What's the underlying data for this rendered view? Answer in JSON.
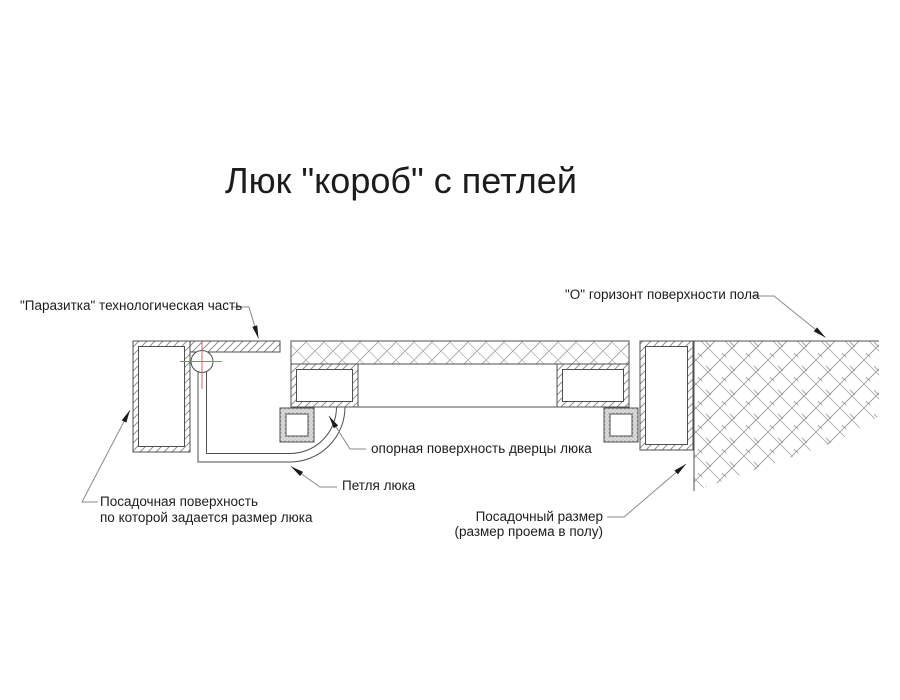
{
  "title": "Люк \"короб\" с петлей",
  "labels": {
    "parasitka": "\"Паразитка\" технологическая часть",
    "horizon": "\"О\" горизонт поверхности пола",
    "support": "опорная поверхность дверцы люка",
    "hinge": "Петля люка",
    "seat_line1": "Посадочная поверхность",
    "seat_line2": "по которой задается размер люка",
    "size_line1": "Посадочный размер",
    "size_line2": "(размер проема в полу)"
  },
  "colors": {
    "line": "#4f4f4f",
    "leader": "#8a8a8a",
    "hatch": "#909090",
    "centermark": "#cc6a6a",
    "arrow": "#1a1a1a",
    "text": "#1c1c1c",
    "background": "#ffffff"
  }
}
